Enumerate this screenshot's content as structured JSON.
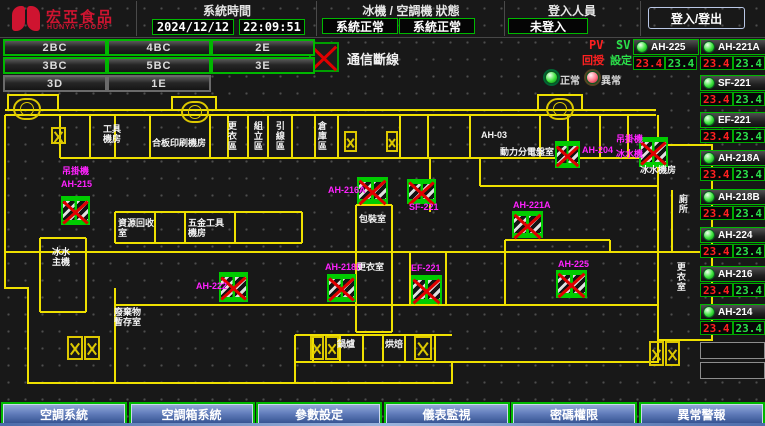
{
  "header": {
    "logo_text": "宏亞食品",
    "logo_subtext": "HUNYA FOODS",
    "time_section_label": "系統時間",
    "date": "2024/12/12",
    "time": "22:09:51",
    "status_section_label": "冰機 / 空調機 狀態",
    "chiller_status": "系統正常",
    "ac_status": "系統正常",
    "login_section_label": "登入人員",
    "login_status": "未登入",
    "login_button": "登入/登出"
  },
  "floor_buttons": [
    {
      "label": "2BC"
    },
    {
      "label": "4BC"
    },
    {
      "label": "2E"
    },
    {
      "label": "3BC"
    },
    {
      "label": "5BC"
    },
    {
      "label": "3E"
    },
    {
      "label": "3D"
    },
    {
      "label": "1E"
    }
  ],
  "legend": {
    "comm_loss": "通信斷線",
    "pv": "PV",
    "sv": "SV",
    "pv_name": "回授",
    "sv_name": "設定",
    "normal": "正常",
    "abnormal": "異常"
  },
  "panel": {
    "top": [
      {
        "name": "AH-225",
        "pv": "23.4",
        "sv": "23.4"
      },
      {
        "name": "AH-221A",
        "pv": "23.4",
        "sv": "23.4"
      }
    ],
    "rows": [
      {
        "name": "SF-221",
        "pv": "23.4",
        "sv": "23.4"
      },
      {
        "name": "EF-221",
        "pv": "23.4",
        "sv": "23.4"
      },
      {
        "name": "AH-218A",
        "pv": "23.4",
        "sv": "23.4"
      },
      {
        "name": "AH-218B",
        "pv": "23.4",
        "sv": "23.4"
      },
      {
        "name": "AH-224",
        "pv": "23.4",
        "sv": "23.4"
      },
      {
        "name": "AH-216",
        "pv": "23.4",
        "sv": "23.4"
      },
      {
        "name": "AH-214",
        "pv": "23.4",
        "sv": "23.4"
      }
    ],
    "empty_slots": 2
  },
  "plan": {
    "markers": [
      {
        "n": "AH-215",
        "x": 61,
        "y": 196,
        "w": 29,
        "h": 29
      },
      {
        "n": "AH-216A",
        "x": 357,
        "y": 177,
        "w": 31,
        "h": 27
      },
      {
        "n": "SF-221",
        "x": 407,
        "y": 179,
        "w": 29,
        "h": 25
      },
      {
        "n": "AH-221A",
        "x": 512,
        "y": 211,
        "w": 31,
        "h": 27
      },
      {
        "n": "AH-204",
        "x": 555,
        "y": 141,
        "w": 25,
        "h": 27
      },
      {
        "n": "冰水機",
        "x": 639,
        "y": 137,
        "w": 29,
        "h": 30
      },
      {
        "n": "AH-222",
        "x": 219,
        "y": 272,
        "w": 29,
        "h": 30
      },
      {
        "n": "AH-218B",
        "x": 327,
        "y": 274,
        "w": 29,
        "h": 28
      },
      {
        "n": "EF-221",
        "x": 411,
        "y": 275,
        "w": 31,
        "h": 29
      },
      {
        "n": "AH-225",
        "x": 556,
        "y": 270,
        "w": 31,
        "h": 28
      }
    ],
    "equip_labels": [
      {
        "t": "吊掛機",
        "x": 62,
        "y": 167
      },
      {
        "t": "AH-215",
        "x": 61,
        "y": 180
      },
      {
        "t": "AH-216A",
        "x": 328,
        "y": 186
      },
      {
        "t": "SF-221",
        "x": 409,
        "y": 203
      },
      {
        "t": "AH-221A",
        "x": 513,
        "y": 201
      },
      {
        "t": "AH-204",
        "x": 582,
        "y": 146
      },
      {
        "t": "吊掛機",
        "x": 616,
        "y": 135
      },
      {
        "t": "冰水機",
        "x": 616,
        "y": 150
      },
      {
        "t": "AH-222",
        "x": 196,
        "y": 282
      },
      {
        "t": "AH-218B",
        "x": 325,
        "y": 263
      },
      {
        "t": "EF-221",
        "x": 411,
        "y": 264
      },
      {
        "t": "AH-225",
        "x": 558,
        "y": 260
      }
    ],
    "room_labels": [
      {
        "t": "工具\n機房",
        "x": 103,
        "y": 125
      },
      {
        "t": "合板印刷機房",
        "x": 152,
        "y": 139
      },
      {
        "t": "更衣區",
        "x": 226,
        "y": 121,
        "v": true
      },
      {
        "t": "組立區",
        "x": 252,
        "y": 121,
        "v": true
      },
      {
        "t": "引線區",
        "x": 274,
        "y": 121,
        "v": true
      },
      {
        "t": "倉庫區",
        "x": 316,
        "y": 121,
        "v": true
      },
      {
        "t": "AH-03",
        "x": 481,
        "y": 131
      },
      {
        "t": "動力分電盤室",
        "x": 500,
        "y": 148
      },
      {
        "t": "冰水機房",
        "x": 640,
        "y": 166
      },
      {
        "t": "包裝室",
        "x": 359,
        "y": 215
      },
      {
        "t": "資源回收\n室",
        "x": 118,
        "y": 219
      },
      {
        "t": "五金工具\n機房",
        "x": 188,
        "y": 219
      },
      {
        "t": "冰水\n主機",
        "x": 52,
        "y": 248
      },
      {
        "t": "廢棄物\n暫存室",
        "x": 114,
        "y": 308
      },
      {
        "t": "更衣室",
        "x": 357,
        "y": 263
      },
      {
        "t": "鍋爐",
        "x": 337,
        "y": 340
      },
      {
        "t": "烘焙",
        "x": 385,
        "y": 340
      },
      {
        "t": "廁所",
        "x": 677,
        "y": 194,
        "v": true
      },
      {
        "t": "更衣室",
        "x": 675,
        "y": 262,
        "v": true
      }
    ],
    "stairs": [
      {
        "x": 51,
        "y": 127,
        "w": 15,
        "h": 17
      },
      {
        "x": 344,
        "y": 131,
        "w": 13,
        "h": 21
      },
      {
        "x": 386,
        "y": 131,
        "w": 12,
        "h": 21
      },
      {
        "x": 67,
        "y": 336,
        "w": 16,
        "h": 24
      },
      {
        "x": 84,
        "y": 336,
        "w": 16,
        "h": 24
      },
      {
        "x": 310,
        "y": 336,
        "w": 14,
        "h": 24
      },
      {
        "x": 325,
        "y": 336,
        "w": 14,
        "h": 24
      },
      {
        "x": 414,
        "y": 336,
        "w": 18,
        "h": 24
      },
      {
        "x": 649,
        "y": 341,
        "w": 15,
        "h": 25
      },
      {
        "x": 665,
        "y": 341,
        "w": 15,
        "h": 25
      }
    ],
    "fans": [
      {
        "x": 13,
        "y": 98
      },
      {
        "x": 181,
        "y": 101
      },
      {
        "x": 546,
        "y": 98
      }
    ]
  },
  "footer": {
    "buttons": [
      {
        "label": "空調系統"
      },
      {
        "label": "空調箱系統"
      },
      {
        "label": "參數設定"
      },
      {
        "label": "儀表監視"
      },
      {
        "label": "密碼權限"
      },
      {
        "label": "異常警報"
      }
    ]
  },
  "colors": {
    "accent_green": "#00b800",
    "wall_yellow": "#efe000",
    "alarm_red": "#e00000",
    "equip_magenta": "#ff22ff",
    "button_blue": "#32508e",
    "logo_red": "#cf1430"
  }
}
